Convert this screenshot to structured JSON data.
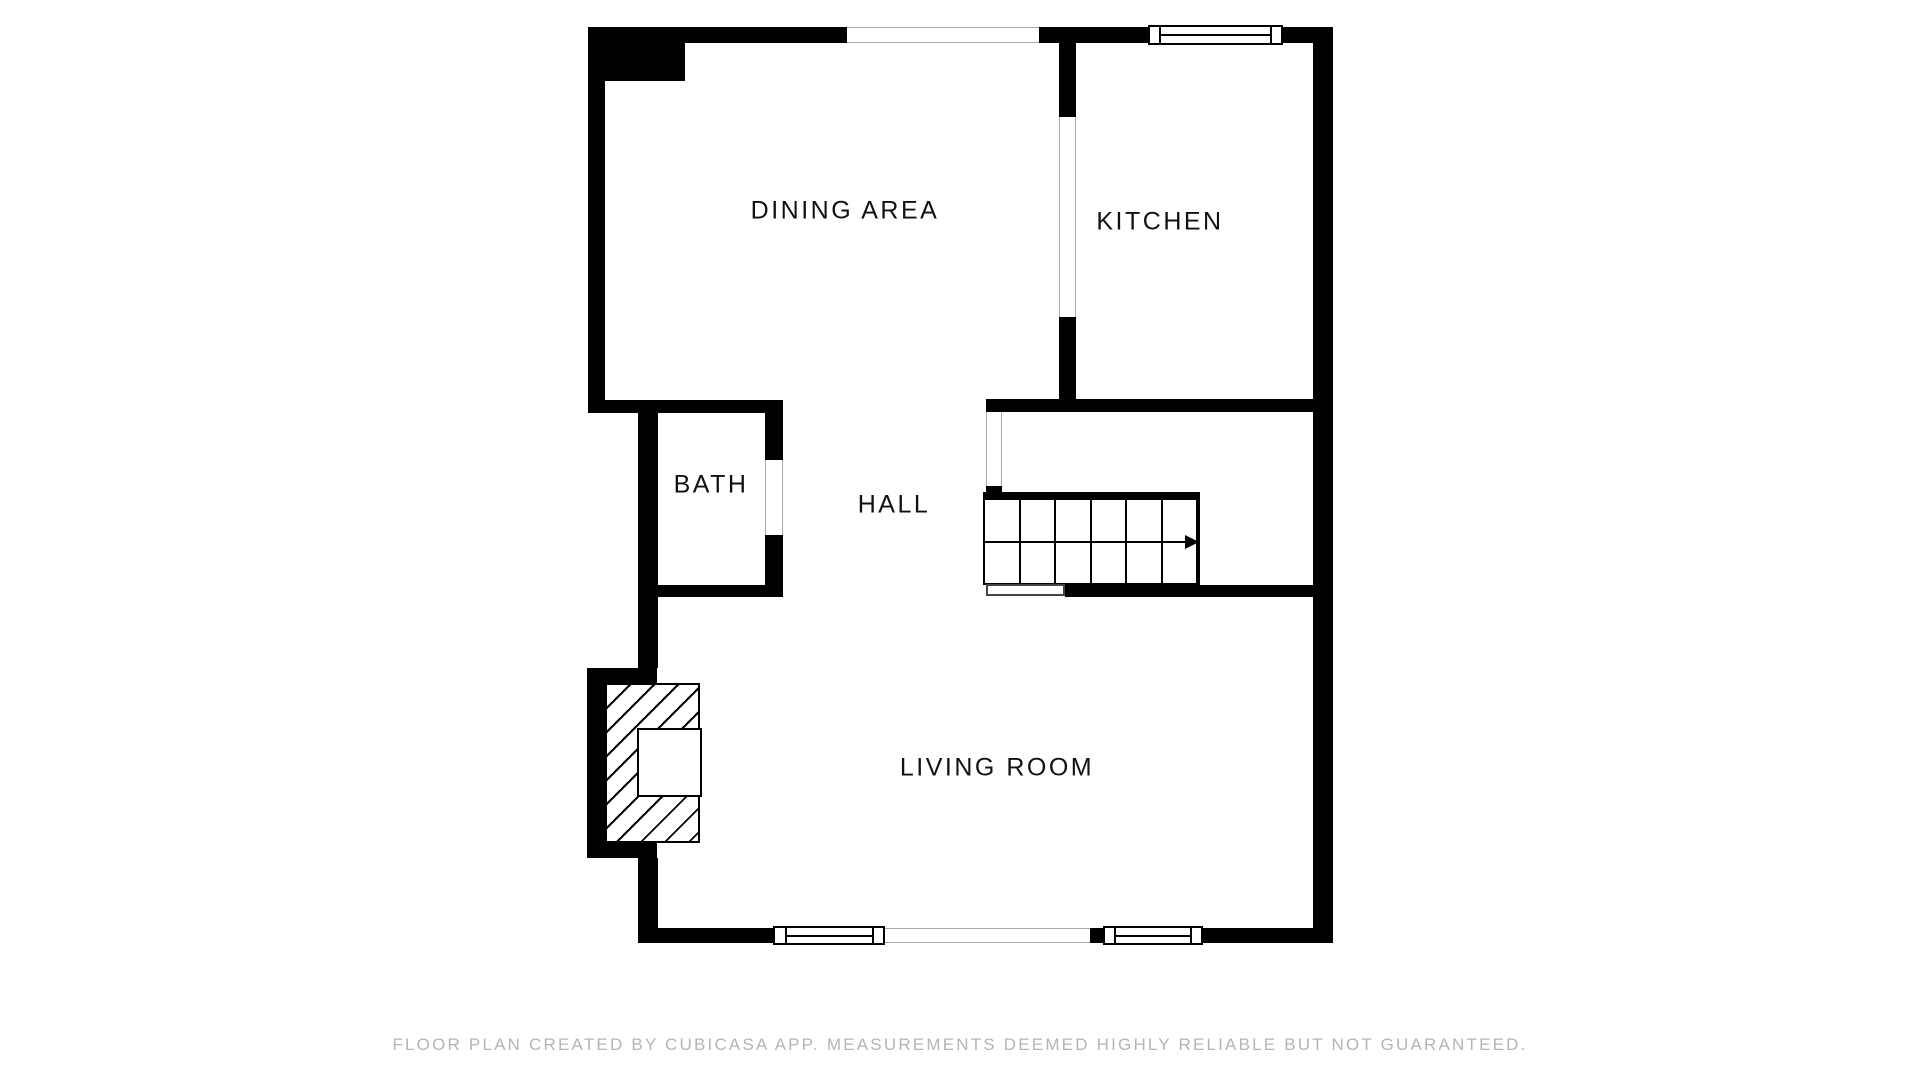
{
  "floor_plan": {
    "rooms": [
      {
        "id": "dining-area",
        "label": "DINING AREA"
      },
      {
        "id": "kitchen",
        "label": "KITCHEN"
      },
      {
        "id": "bath",
        "label": "BATH"
      },
      {
        "id": "hall",
        "label": "HALL"
      },
      {
        "id": "living-room",
        "label": "LIVING ROOM"
      }
    ],
    "stairs": {
      "columns": 6,
      "rows": 2,
      "direction_icon": "right-arrow"
    },
    "footer": "FLOOR PLAN CREATED BY CUBICASA APP. MEASUREMENTS DEEMED HIGHLY RELIABLE BUT NOT GUARANTEED.",
    "colors": {
      "wall": "#000000",
      "background": "#ffffff",
      "label_text": "#111111",
      "footer_text": "#b5b5b5",
      "opening_line": "#aaaaaa"
    }
  }
}
